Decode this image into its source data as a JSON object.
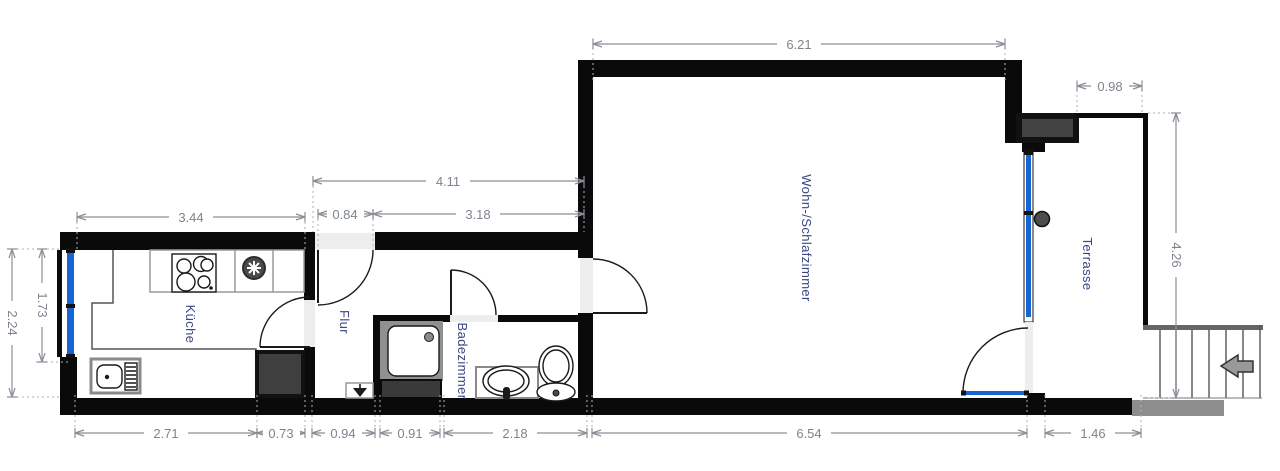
{
  "title": "floor-plan",
  "rooms": [
    {
      "id": "kueche",
      "label": "Küche"
    },
    {
      "id": "flur",
      "label": "Flur"
    },
    {
      "id": "badezimmer",
      "label": "Badezimmer"
    },
    {
      "id": "wohn_schlafzimmer",
      "label": "Wohn-/Schlafzimmer"
    },
    {
      "id": "terrasse",
      "label": "Terrasse"
    }
  ],
  "dims": {
    "living_top": "6.21",
    "terrace_top": "0.98",
    "hall_top_total": "4.11",
    "entry_door": "0.84",
    "hall_top": "3.18",
    "kitchen_top": "3.44",
    "window_left": "1.73",
    "kitchen_left": "2.24",
    "terrace_right": "4.26",
    "kitchen_bottom": "2.71",
    "fridge_nook_bottom": "0.73",
    "hall_bottom": "0.94",
    "shower_bottom": "0.91",
    "bath_bottom": "2.18",
    "living_bottom": "6.54",
    "terrace_bottom": "1.46"
  },
  "fixtures": [
    "stove-icon",
    "extractor-fan-icon",
    "kitchen-sink-icon",
    "fridge-icon",
    "shower-icon",
    "washbasin-icon",
    "toilet-icon",
    "stairs-icon",
    "stairs-direction-arrow-icon",
    "entrance-arrow-icon",
    "door-swing-icon",
    "window-icon",
    "glass-door-icon",
    "door-knob-icon",
    "chimney-icon"
  ],
  "colors": {
    "wall": "#0a0a0a",
    "window_blue": "#1565d4",
    "opening_gray": "#ededed",
    "dimension_gray": "#7e848e",
    "label_blue": "#3a4684",
    "stairs_gray": "#8d8d8d",
    "fixture_dark_gray": "#3f3f3f"
  }
}
